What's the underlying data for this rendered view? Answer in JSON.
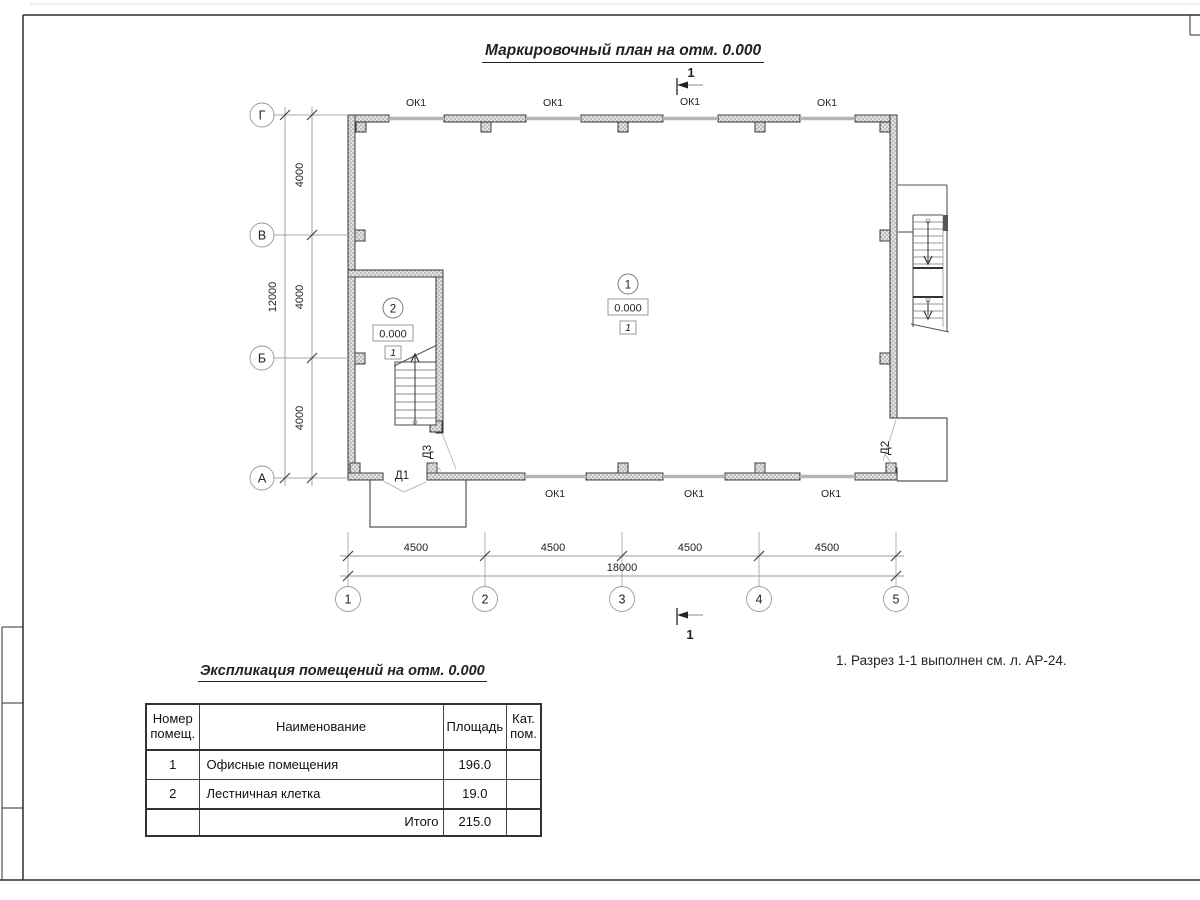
{
  "title": "Маркировочный план на отм. 0.000",
  "note": "1. Разрез 1-1 выполнен см. л. АР-24.",
  "plan": {
    "window_label": "ОК1",
    "section_mark": "1",
    "doors": {
      "d1": "Д1",
      "d2": "Д2",
      "d3": "Д3"
    },
    "rooms": [
      {
        "number": "1",
        "elevation": "0.000",
        "floor_type": "1"
      },
      {
        "number": "2",
        "elevation": "0.000",
        "floor_type": "1"
      }
    ],
    "axes": {
      "vertical": [
        "Г",
        "В",
        "Б",
        "А"
      ],
      "horizontal": [
        "1",
        "2",
        "3",
        "4",
        "5"
      ],
      "dim_vertical_segments": [
        "4000",
        "4000",
        "4000"
      ],
      "dim_vertical_total": "12000",
      "dim_horizontal_segments": [
        "4500",
        "4500",
        "4500",
        "4500"
      ],
      "dim_horizontal_total": "18000"
    }
  },
  "table": {
    "title": "Экспликация помещений на отм. 0.000",
    "headers": {
      "number": "Номер помещ.",
      "name": "Наименование",
      "area": "Площадь",
      "category": "Кат. пом."
    },
    "rows": [
      {
        "number": "1",
        "name": "Офисные помещения",
        "area": "196.0",
        "category": ""
      },
      {
        "number": "2",
        "name": "Лестничная клетка",
        "area": "19.0",
        "category": ""
      }
    ],
    "total_label": "Итого",
    "total_area": "215.0"
  }
}
